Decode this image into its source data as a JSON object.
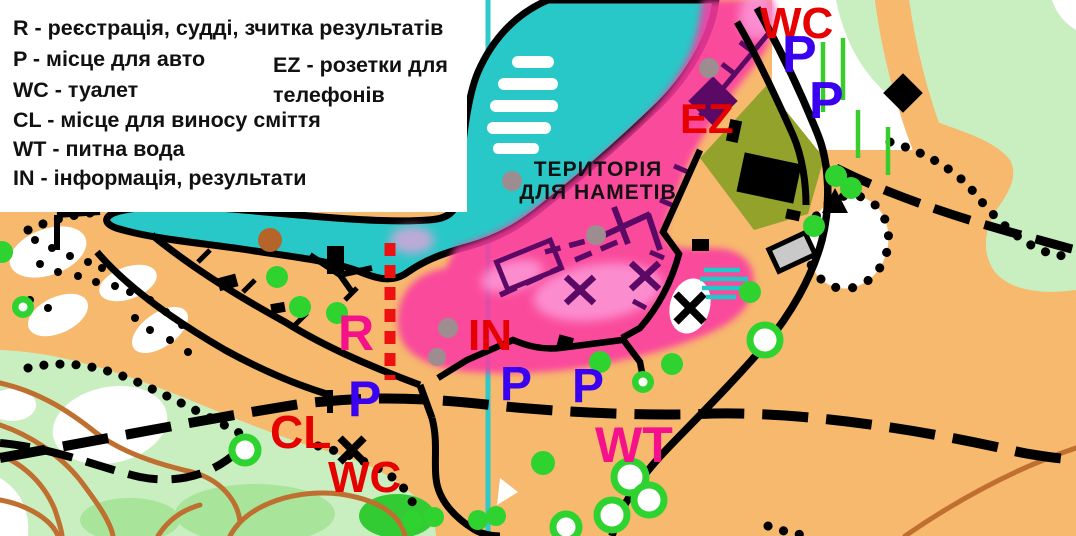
{
  "legend": {
    "items": [
      "R - реєстрація, судді, зчитка результатів",
      "P - місце для авто",
      "WC - туалет",
      "CL - місце для виносу сміття",
      "WT - питна вода",
      "IN - інформація, результати"
    ],
    "column2": [
      "EZ - розетки для",
      "телефонів"
    ]
  },
  "tent_area": {
    "line1": "ТЕРИТОРІЯ",
    "line2": "ДЛЯ НАМЕТІВ"
  },
  "markers": {
    "wc_top": "WC",
    "p_top_1": "P",
    "p_top_2": "P",
    "ez": "EZ",
    "r": "R",
    "in": "IN",
    "p_left": "P",
    "p_center_1": "P",
    "p_center_2": "P",
    "cl": "CL",
    "wc_bottom": "WC",
    "wt": "WT"
  },
  "colors": {
    "terrain_open": "#F6B96E",
    "water": "#29C8C8",
    "tent_zone": "#FB3BA2",
    "vegetation_light": "#C9EFC1",
    "vegetation_medium": "#A8E59A",
    "vegetation_vivid": "#33CB33",
    "settlement_olive": "#93A22A",
    "contour_brown": "#BF6F2F",
    "fence_purple": "#5A0A64",
    "label_red": "#E60000",
    "label_blue": "#3A00F0",
    "label_magenta": "#F5118C",
    "north_line_cyan": "#2FC9C9",
    "event_line_red": "#EE1111"
  }
}
